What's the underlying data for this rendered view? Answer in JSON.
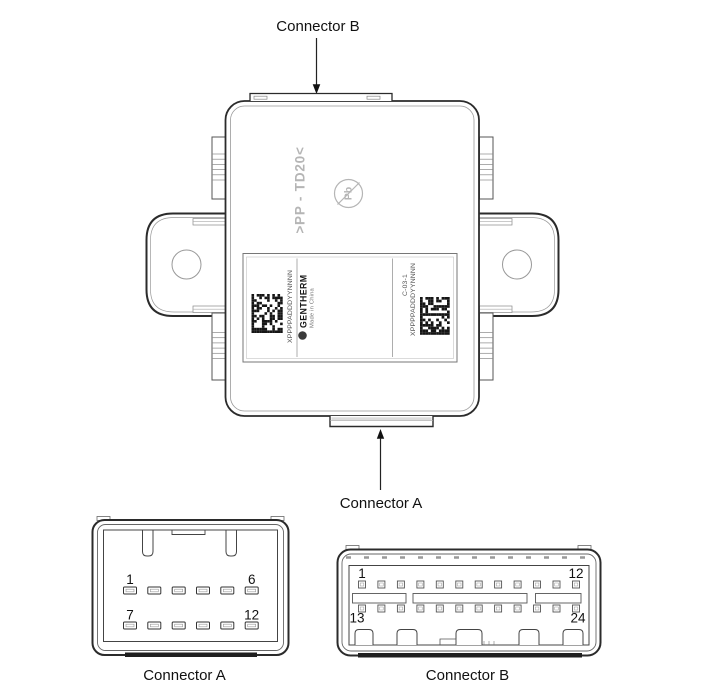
{
  "diagram": {
    "pointer_labels": {
      "top": "Connector B",
      "bottom": "Connector A"
    }
  },
  "module": {
    "molded_code": ">PP - TD20<",
    "pb_free_mark": "Pb",
    "sticker": {
      "left_serial": "XPPPPADDDYYNNNN",
      "brand": "GENTHERM",
      "origin": "Made in China",
      "part_code": "C-03-1",
      "right_serial": "XPPPPADDDYYNNNN"
    }
  },
  "connector_a": {
    "caption": "Connector A",
    "pins": {
      "first_top": "1",
      "last_top": "6",
      "first_bottom": "7",
      "last_bottom": "12"
    }
  },
  "connector_b": {
    "caption": "Connector B",
    "pins": {
      "first_top": "1",
      "last_top": "12",
      "first_bottom": "13",
      "last_bottom": "24"
    }
  },
  "colors": {
    "outline": "#2b2b2b",
    "secondary_line": "#888888",
    "thin_line": "#999999",
    "molded_gray": "#b5b5b5",
    "dark_band": "#1f1f1f",
    "background": "#ffffff"
  }
}
